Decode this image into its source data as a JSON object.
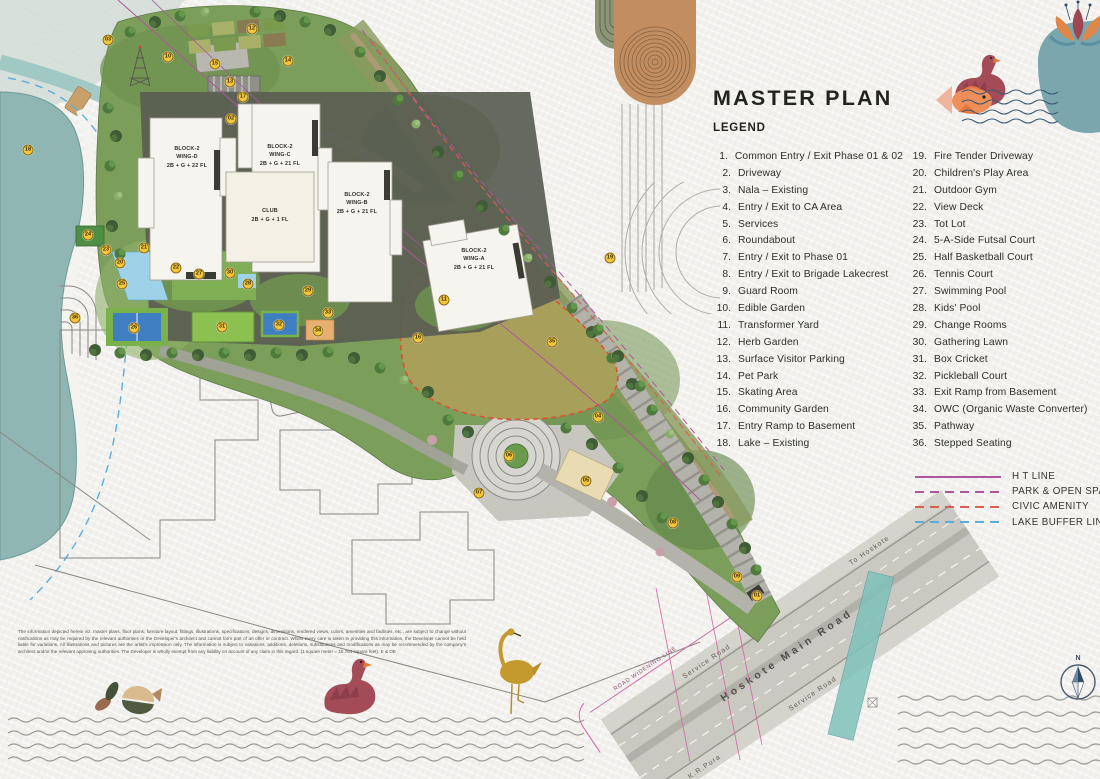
{
  "title": "MASTER PLAN",
  "legend": {
    "heading": "LEGEND",
    "items": [
      {
        "n": "1.",
        "label": "Common Entry / Exit Phase 01 & 02"
      },
      {
        "n": "2.",
        "label": "Driveway"
      },
      {
        "n": "3.",
        "label": "Nala – Existing"
      },
      {
        "n": "4.",
        "label": "Entry / Exit to CA Area"
      },
      {
        "n": "5.",
        "label": "Services"
      },
      {
        "n": "6.",
        "label": "Roundabout"
      },
      {
        "n": "7.",
        "label": "Entry / Exit to Phase 01"
      },
      {
        "n": "8.",
        "label": "Entry / Exit to Brigade Lakecrest"
      },
      {
        "n": "9.",
        "label": "Guard Room"
      },
      {
        "n": "10.",
        "label": "Edible Garden"
      },
      {
        "n": "11.",
        "label": "Transformer Yard"
      },
      {
        "n": "12.",
        "label": "Herb Garden"
      },
      {
        "n": "13.",
        "label": "Surface Visitor Parking"
      },
      {
        "n": "14.",
        "label": "Pet Park"
      },
      {
        "n": "15.",
        "label": "Skating Area"
      },
      {
        "n": "16.",
        "label": "Community Garden"
      },
      {
        "n": "17.",
        "label": "Entry Ramp to Basement"
      },
      {
        "n": "18.",
        "label": "Lake – Existing"
      },
      {
        "n": "19.",
        "label": "Fire Tender Driveway"
      },
      {
        "n": "20.",
        "label": "Children's Play Area"
      },
      {
        "n": "21.",
        "label": "Outdoor Gym"
      },
      {
        "n": "22.",
        "label": "View Deck"
      },
      {
        "n": "23.",
        "label": "Tot Lot"
      },
      {
        "n": "24.",
        "label": "5-A-Side Futsal Court"
      },
      {
        "n": "25.",
        "label": "Half Basketball Court"
      },
      {
        "n": "26.",
        "label": "Tennis Court"
      },
      {
        "n": "27.",
        "label": "Swimming Pool"
      },
      {
        "n": "28.",
        "label": "Kids' Pool"
      },
      {
        "n": "29.",
        "label": "Change Rooms"
      },
      {
        "n": "30.",
        "label": "Gathering Lawn"
      },
      {
        "n": "31.",
        "label": "Box Cricket"
      },
      {
        "n": "32.",
        "label": "Pickleball Court"
      },
      {
        "n": "33.",
        "label": "Exit Ramp from Basement"
      },
      {
        "n": "34.",
        "label": "OWC (Organic Waste Converter)"
      },
      {
        "n": "35.",
        "label": "Pathway"
      },
      {
        "n": "36.",
        "label": "Stepped Seating"
      }
    ],
    "lines": [
      {
        "label": "H T LINE",
        "color": "#b0549c",
        "style": "solid"
      },
      {
        "label": "PARK & OPEN SPACES",
        "color": "#b0549c",
        "style": "dashed"
      },
      {
        "label": "CIVIC AMENITY",
        "color": "#d95f50",
        "style": "dashed"
      },
      {
        "label": "LAKE BUFFER LINE",
        "color": "#5aaede",
        "style": "dashed"
      }
    ]
  },
  "map": {
    "buildings": [
      {
        "name": "BLOCK-2",
        "wing": "WING-D",
        "floors": "2B + G + 22 FL"
      },
      {
        "name": "BLOCK-2",
        "wing": "WING-C",
        "floors": "2B + G + 21 FL"
      },
      {
        "name": "CLUB",
        "wing": "",
        "floors": "2B + G + 1 FL"
      },
      {
        "name": "BLOCK-2",
        "wing": "WING-B",
        "floors": "2B + G + 21 FL"
      },
      {
        "name": "BLOCK-2",
        "wing": "WING-A",
        "floors": "2B + G + 21 FL"
      }
    ],
    "roads": {
      "main": "Hoskote Main Road",
      "to_hoskote": "To Hoskote",
      "service_road": "Service Road",
      "to_krpura": "To K.R.Pura",
      "widening": "ROAD WIDENING LINE"
    },
    "compass_n": "N",
    "markers": [
      {
        "n": "01",
        "x": 757,
        "y": 596
      },
      {
        "n": "02",
        "x": 231,
        "y": 119
      },
      {
        "n": "03",
        "x": 108,
        "y": 40
      },
      {
        "n": "04",
        "x": 598,
        "y": 417
      },
      {
        "n": "05",
        "x": 586,
        "y": 481
      },
      {
        "n": "06",
        "x": 509,
        "y": 456
      },
      {
        "n": "07",
        "x": 479,
        "y": 493
      },
      {
        "n": "08",
        "x": 673,
        "y": 523
      },
      {
        "n": "09",
        "x": 737,
        "y": 577
      },
      {
        "n": "10",
        "x": 168,
        "y": 57
      },
      {
        "n": "11",
        "x": 444,
        "y": 300
      },
      {
        "n": "12",
        "x": 252,
        "y": 29
      },
      {
        "n": "13",
        "x": 230,
        "y": 82
      },
      {
        "n": "14",
        "x": 288,
        "y": 61
      },
      {
        "n": "15",
        "x": 215,
        "y": 64
      },
      {
        "n": "16",
        "x": 418,
        "y": 338
      },
      {
        "n": "17",
        "x": 243,
        "y": 97
      },
      {
        "n": "18",
        "x": 28,
        "y": 150
      },
      {
        "n": "19",
        "x": 610,
        "y": 258
      },
      {
        "n": "20",
        "x": 120,
        "y": 263
      },
      {
        "n": "21",
        "x": 144,
        "y": 248
      },
      {
        "n": "22",
        "x": 176,
        "y": 268
      },
      {
        "n": "23",
        "x": 106,
        "y": 250
      },
      {
        "n": "24",
        "x": 88,
        "y": 235
      },
      {
        "n": "25",
        "x": 122,
        "y": 284
      },
      {
        "n": "26",
        "x": 134,
        "y": 328
      },
      {
        "n": "27",
        "x": 199,
        "y": 274
      },
      {
        "n": "28",
        "x": 248,
        "y": 284
      },
      {
        "n": "29",
        "x": 308,
        "y": 291
      },
      {
        "n": "30",
        "x": 230,
        "y": 273
      },
      {
        "n": "31",
        "x": 222,
        "y": 327
      },
      {
        "n": "32",
        "x": 279,
        "y": 325
      },
      {
        "n": "33",
        "x": 328,
        "y": 313
      },
      {
        "n": "34",
        "x": 318,
        "y": 331
      },
      {
        "n": "35",
        "x": 552,
        "y": 342
      },
      {
        "n": "36",
        "x": 75,
        "y": 318
      }
    ]
  },
  "disclaimer": "The information depicted herein viz. master plans, floor plans, furniture layout, fittings, illustrations, specifications, designs, dimensions, rendered views, colors, amenities and facilities, etc., are subject to change without notifications as may be required by the relevant authorities or the Developer's architect and cannot form part of an offer or contract. Whilst every care is taken in providing this information, the Developer cannot be held liable for variations. All illustrations and pictures are the artist's impression only. The information is subject to variations, additions, deletions, substitutions and modifications as may be recommended by the company's architect and/or the relevant approving authorities. The Developer is wholly exempt from any liability on account of any claim in this regard. (1 square meter = 10.764 square feet). E & OE",
  "colors": {
    "paper": "#f2f1ee",
    "site_green": "#7b9e5b",
    "lawn_olive": "#a89f5b",
    "lake_teal": "#8fb6b2",
    "court_blue": "#3f7fc1",
    "pool_blue": "#9ed2e8",
    "marker_yellow": "#f2c73e",
    "ht_line": "#b0549c",
    "civic_line": "#d95f50",
    "lake_buffer": "#5aaede",
    "road_gray": "#c6c5be"
  }
}
